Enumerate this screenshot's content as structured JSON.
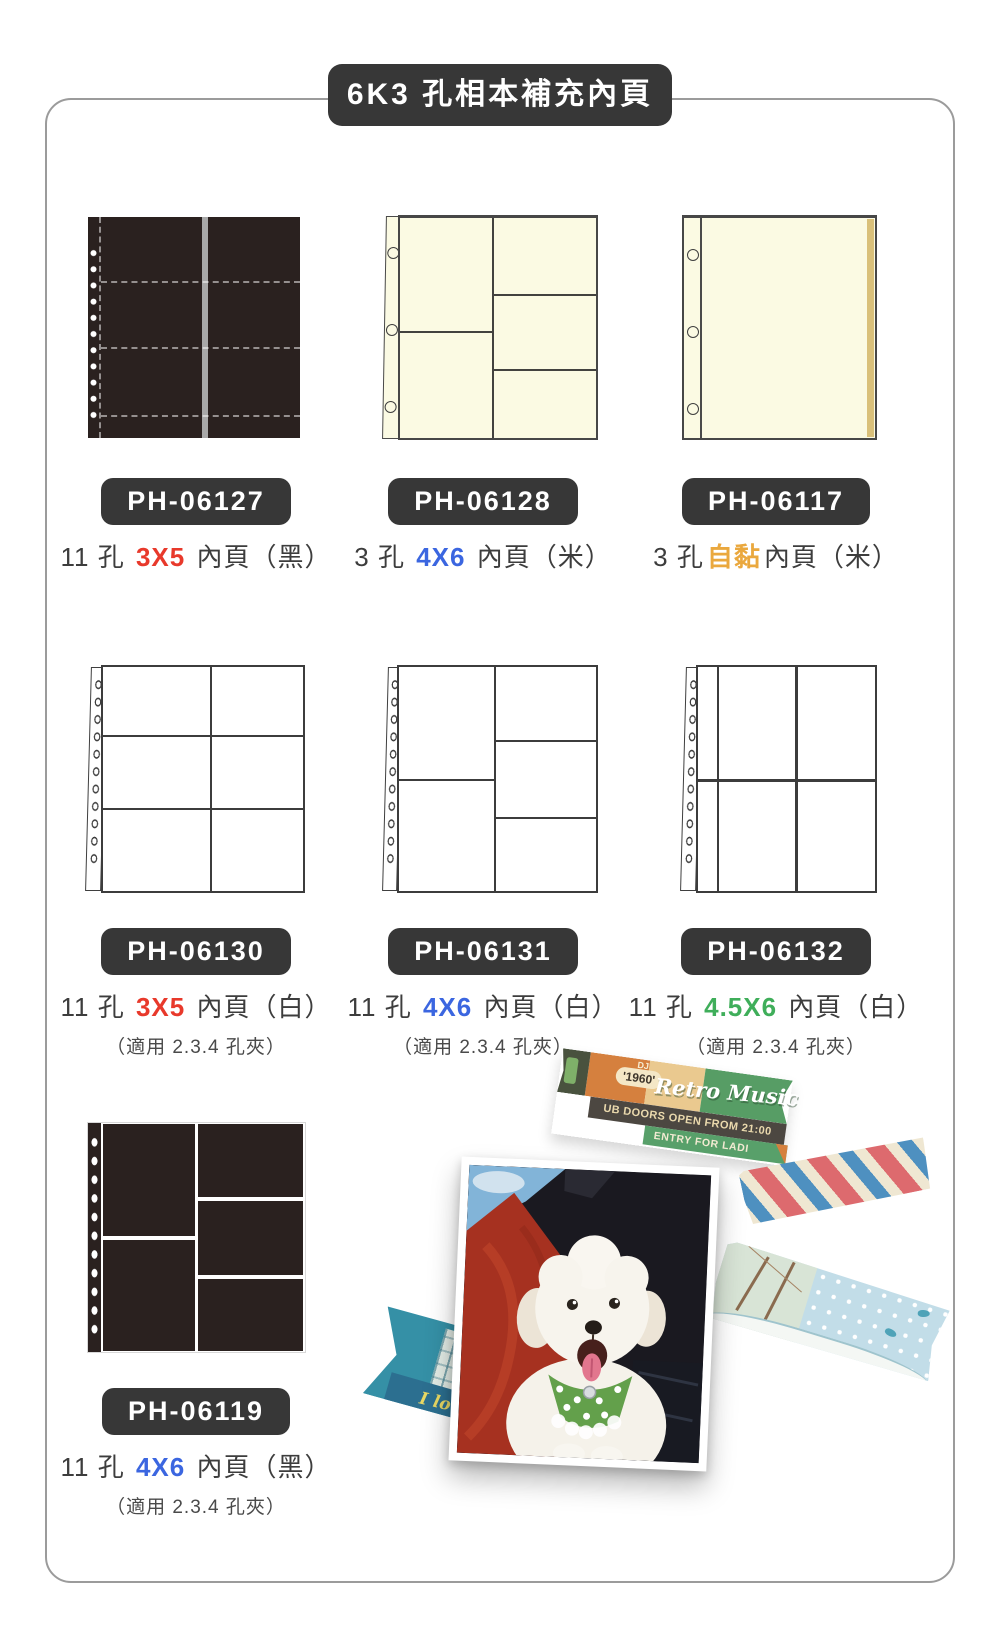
{
  "header": {
    "title": "6K3 孔相本補充內頁"
  },
  "colors": {
    "badge_bg": "#373737",
    "size_red": "#e8392b",
    "size_blue": "#3b66e0",
    "size_orange": "#eaa83e",
    "size_green": "#3fae5a",
    "page_cream": "#fbfae3",
    "page_black": "#2a211f"
  },
  "products": [
    {
      "code": "PH-06127",
      "prefix": "11 孔 ",
      "size": "3X5",
      "size_style": "color:#e8392b",
      "suffix": " 內頁（黑）",
      "note": ""
    },
    {
      "code": "PH-06128",
      "prefix": "3 孔 ",
      "size": "4X6",
      "size_style": "color:#3b66e0",
      "suffix": " 內頁（米）",
      "note": ""
    },
    {
      "code": "PH-06117",
      "prefix": "3 孔",
      "size": "自黏",
      "size_style": "color:#eaa83e",
      "suffix": "內頁（米）",
      "note": ""
    },
    {
      "code": "PH-06130",
      "prefix": "11 孔 ",
      "size": "3X5",
      "size_style": "color:#e8392b",
      "suffix": " 內頁（白）",
      "note": "（適用 2.3.4 孔夾）"
    },
    {
      "code": "PH-06131",
      "prefix": "11 孔 ",
      "size": "4X6",
      "size_style": "color:#3b66e0",
      "suffix": " 內頁（白）",
      "note": "（適用 2.3.4 孔夾）"
    },
    {
      "code": "PH-06132",
      "prefix": "11 孔 ",
      "size": "4.5X6",
      "size_style": "color:#3fae5a",
      "suffix": " 內頁（白）",
      "note": "（適用 2.3.4 孔夾）"
    },
    {
      "code": "PH-06119",
      "prefix": "11 孔 ",
      "size": "4X6",
      "size_style": "color:#3b66e0",
      "suffix": " 內頁（黑）",
      "note": "（適用 2.3.4 孔夾）"
    }
  ],
  "collage": {
    "retro_tape": {
      "dj": "DJ",
      "year": "'1960'",
      "title": "Retro Music",
      "line1": "UB DOORS OPEN FROM 21:00",
      "line2": "ENTRY FOR LADI"
    },
    "london_tape": {
      "script": "I love London"
    }
  }
}
